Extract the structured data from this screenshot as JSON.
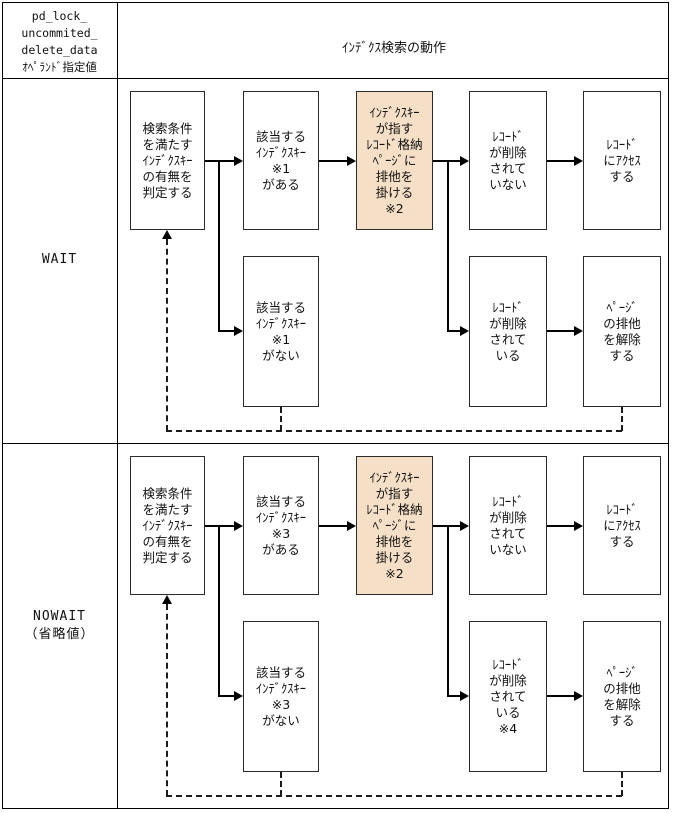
{
  "colors": {
    "highlight_fill": "#f5dfc6",
    "box_border": "#2b2b2b",
    "table_border": "#000000"
  },
  "header": {
    "operand": "pd_lock_\nuncommited_\ndelete_data\nｵﾍﾟﾗﾝﾄﾞ指定値",
    "behavior": "ｲﾝﾃﾞｸｽ検索の動作"
  },
  "rows": [
    {
      "label": "WAIT",
      "boxes": {
        "judge": "検索条件\nを満たす\nｲﾝﾃﾞｸｽｷｰ\nの有無を\n判定する",
        "key_found": "該当する\nｲﾝﾃﾞｸｽｷｰ\n※1\nがある",
        "lock_page": "ｲﾝﾃﾞｸｽｷｰ\nが指す\nﾚｺｰﾄﾞ格納\nﾍﾟｰｼﾞに\n排他を\n掛ける\n※2",
        "not_deleted": "ﾚｺｰﾄﾞ\nが削除\nされて\nいない",
        "access": "ﾚｺｰﾄﾞ\nにｱｸｾｽ\nする",
        "key_not_found": "該当する\nｲﾝﾃﾞｸｽｷｰ\n※1\nがない",
        "deleted": "ﾚｺｰﾄﾞ\nが削除\nされて\nいる",
        "release": "ﾍﾟｰｼﾞ\nの排他\nを解除\nする"
      }
    },
    {
      "label": "NOWAIT\n（省略値）",
      "boxes": {
        "judge": "検索条件\nを満たす\nｲﾝﾃﾞｸｽｷｰ\nの有無を\n判定する",
        "key_found": "該当する\nｲﾝﾃﾞｸｽｷｰ\n※3\nがある",
        "lock_page": "ｲﾝﾃﾞｸｽｷｰ\nが指す\nﾚｺｰﾄﾞ格納\nﾍﾟｰｼﾞに\n排他を\n掛ける\n※2",
        "not_deleted": "ﾚｺｰﾄﾞ\nが削除\nされて\nいない",
        "access": "ﾚｺｰﾄﾞ\nにｱｸｾｽ\nする",
        "key_not_found": "該当する\nｲﾝﾃﾞｸｽｷｰ\n※3\nがない",
        "deleted": "ﾚｺｰﾄﾞ\nが削除\nされて\nいる\n※4",
        "release": "ﾍﾟｰｼﾞ\nの排他\nを解除\nする"
      }
    }
  ]
}
